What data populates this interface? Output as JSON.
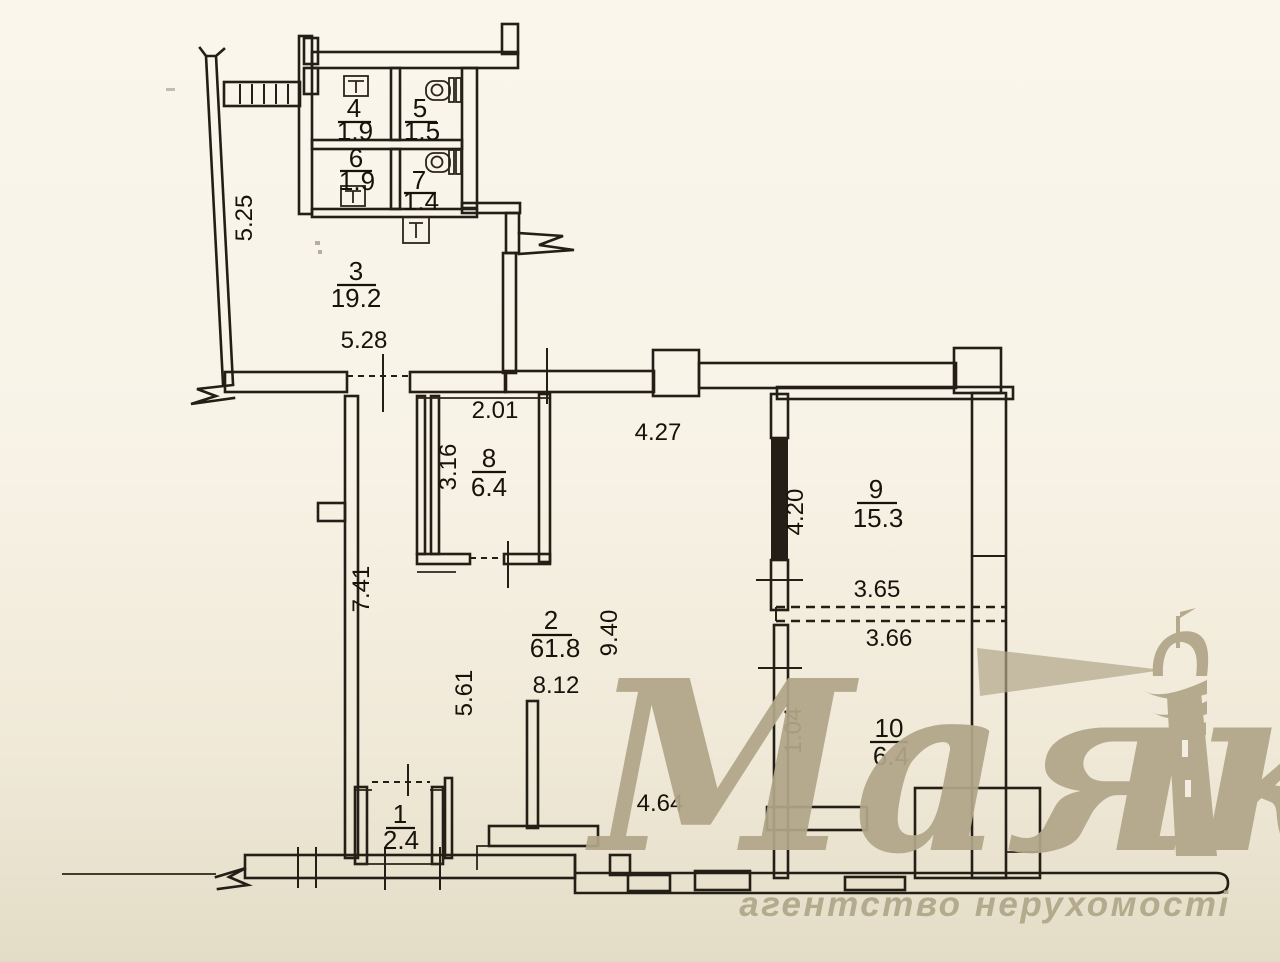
{
  "rooms": {
    "r1": {
      "number": "1",
      "area": "2.4"
    },
    "r2": {
      "number": "2",
      "area": "61.8"
    },
    "r3": {
      "number": "3",
      "area": "19.2"
    },
    "r4": {
      "number": "4",
      "area": "1.9"
    },
    "r5": {
      "number": "5",
      "area": "1.5"
    },
    "r6": {
      "number": "6",
      "area": "1.9"
    },
    "r7": {
      "number": "7",
      "area": "1.4"
    },
    "r8": {
      "number": "8",
      "area": "6.4"
    },
    "r9": {
      "number": "9",
      "area": "15.3"
    },
    "r10": {
      "number": "10",
      "area": "6.4"
    }
  },
  "dimensions": {
    "room3_height": "5.25",
    "room3_width": "5.28",
    "room8_width": "2.01",
    "room8_height": "3.16",
    "corridor_top_width": "4.27",
    "room9_height": "4.20",
    "room9_width": "3.65",
    "room10_width": "3.66",
    "room10_height": "1.04",
    "hall_height": "9.40",
    "hall_width": "8.12",
    "hall_left_height": "7.41",
    "hall_inner_height": "5.61",
    "hall_bottom_width": "4.64"
  },
  "watermark": {
    "brand": "Маяк",
    "tagline": "агентство нерухомості",
    "color": "#b1a689"
  },
  "ink_color": "#241f16"
}
